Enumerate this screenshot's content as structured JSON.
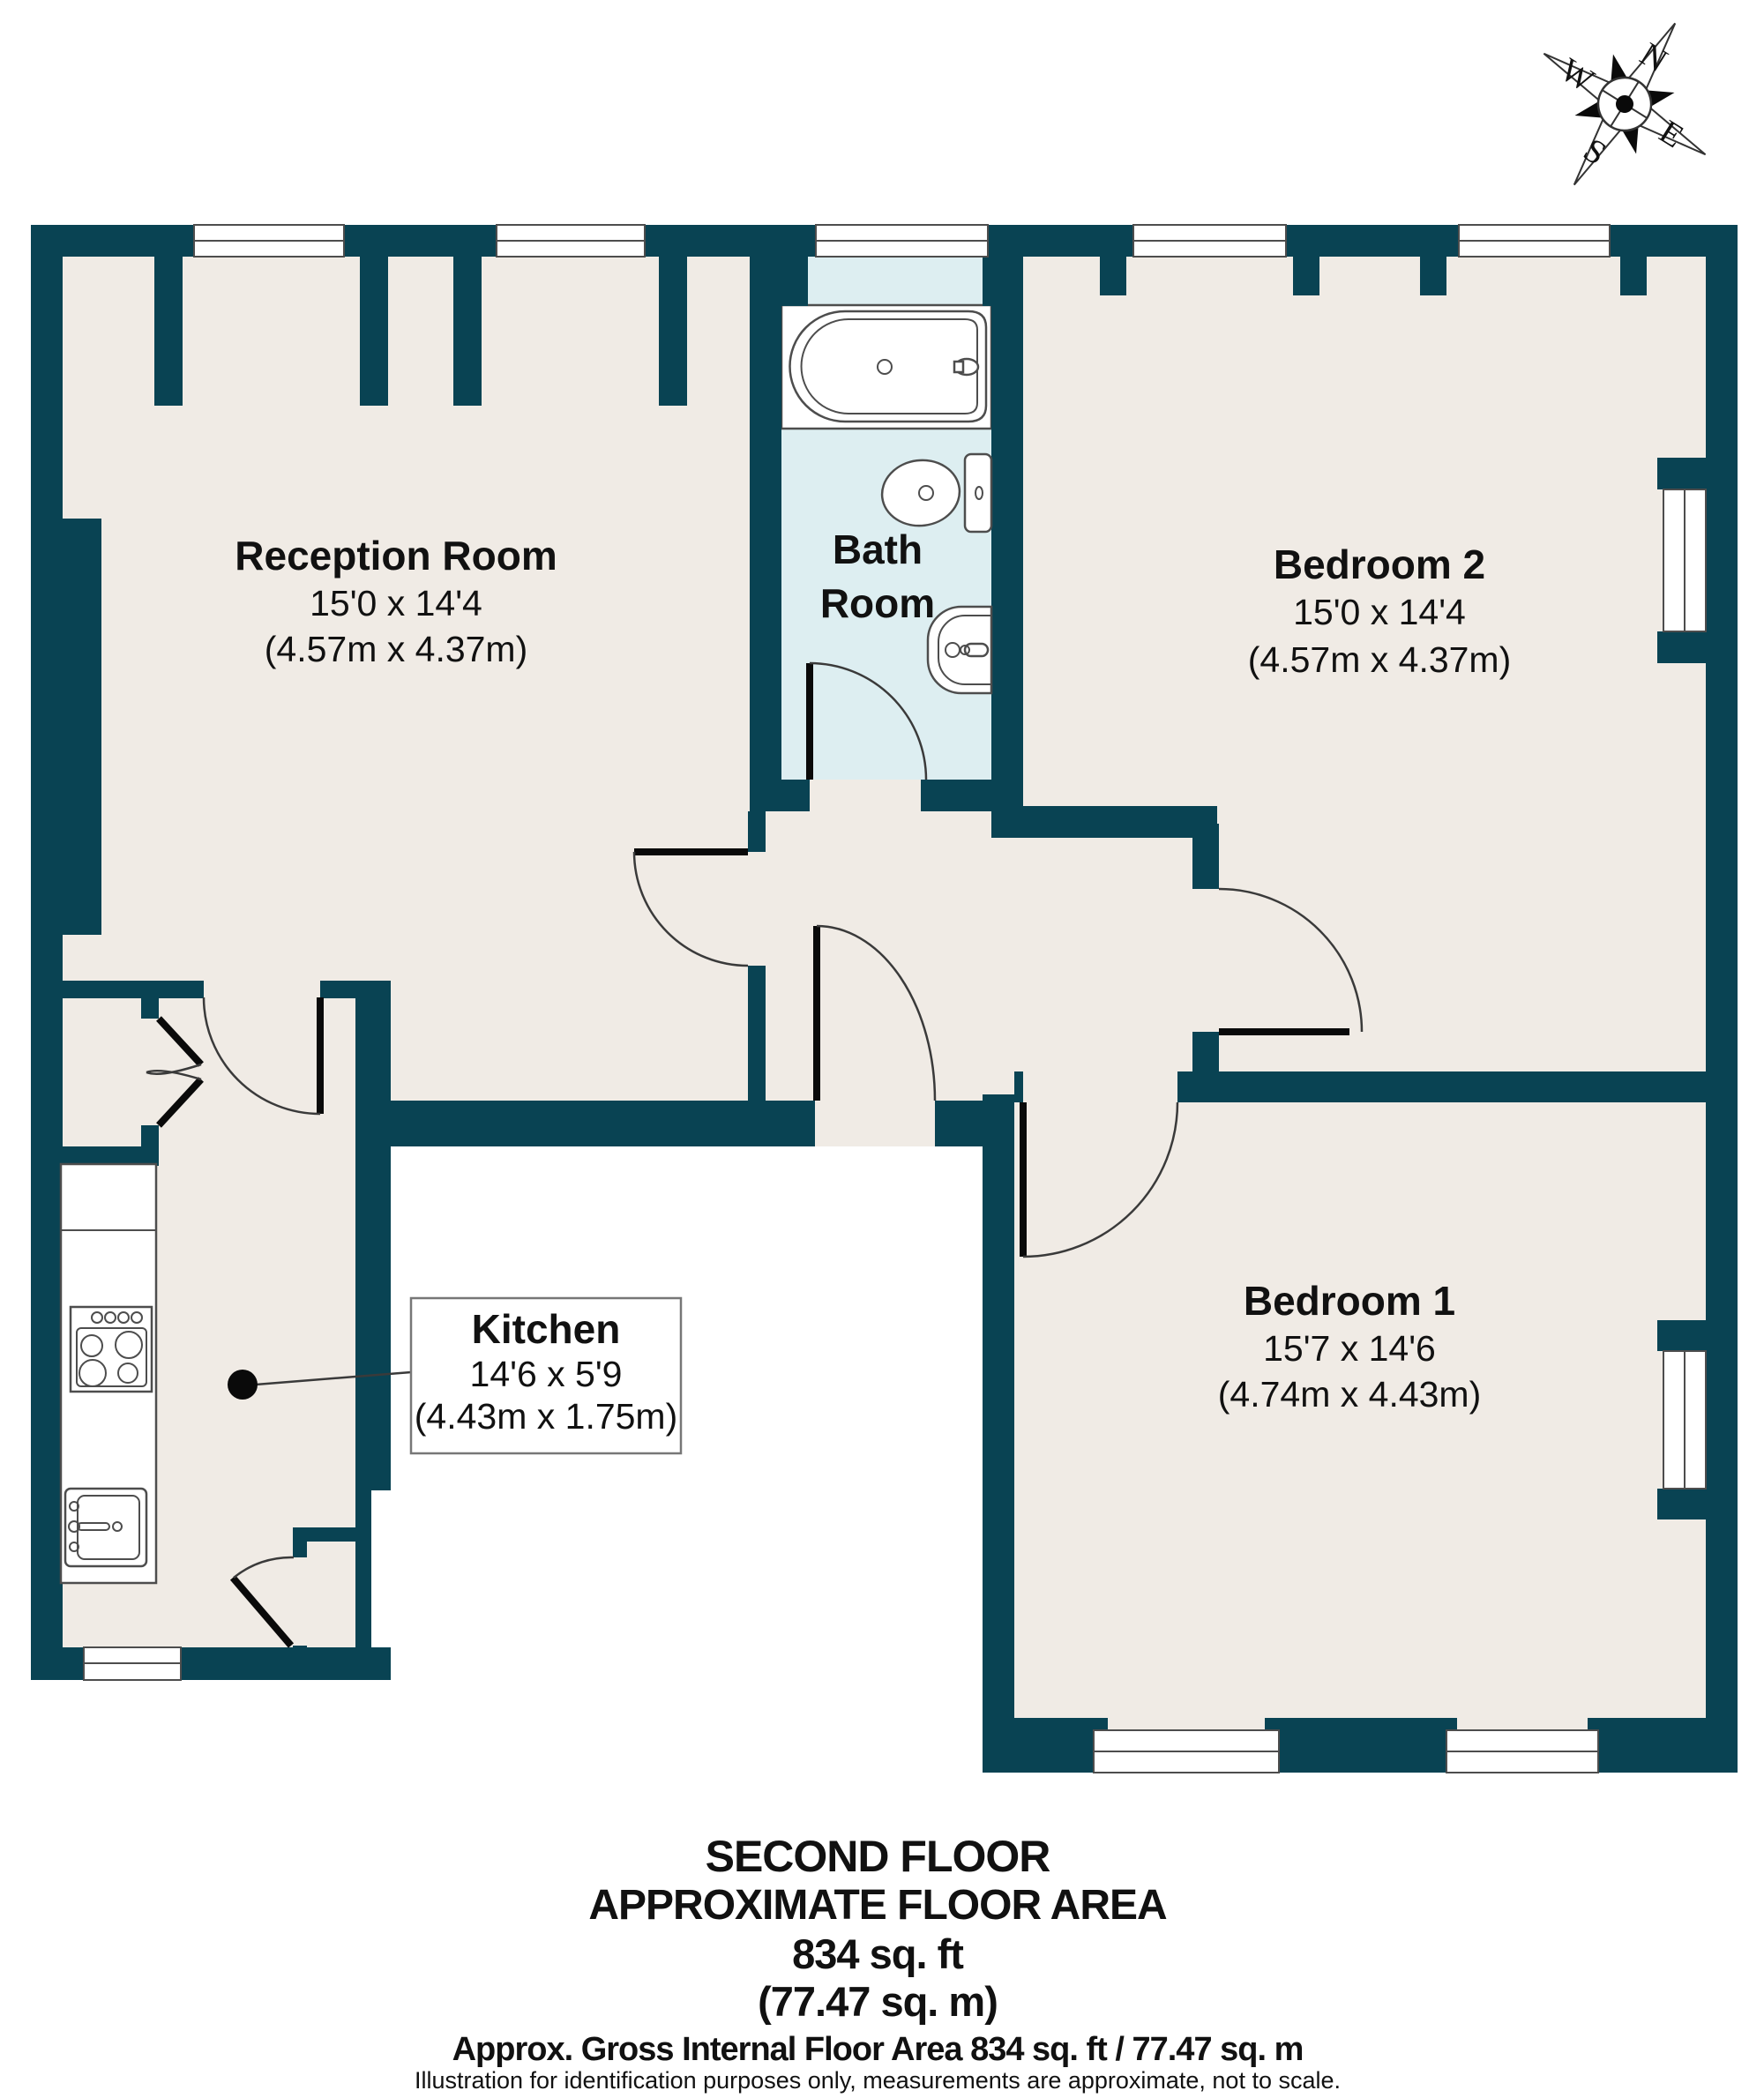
{
  "colors": {
    "wall": "#094353",
    "floor": "#f0ebe5",
    "bathfloor": "#ddeef1",
    "line": "#4d4d4d"
  },
  "rooms": {
    "reception": {
      "name": "Reception Room",
      "imperial": "15'0 x 14'4",
      "metric": "(4.57m x 4.37m)"
    },
    "bathroom": {
      "name_line1": "Bath",
      "name_line2": "Room"
    },
    "bedroom2": {
      "name": "Bedroom 2",
      "imperial": "15'0 x 14'4",
      "metric": "(4.57m x 4.37m)"
    },
    "bedroom1": {
      "name": "Bedroom 1",
      "imperial": "15'7 x 14'6",
      "metric": "(4.74m x 4.43m)"
    },
    "kitchen": {
      "name": "Kitchen",
      "imperial": "14'6 x 5'9",
      "metric": "(4.43m x 1.75m)"
    }
  },
  "compass": {
    "north": "N",
    "east": "E",
    "south": "S",
    "west": "W"
  },
  "footer": {
    "line1": "SECOND FLOOR",
    "line2": "APPROXIMATE FLOOR AREA",
    "line3": "834 sq. ft",
    "line4": "(77.47 sq. m)",
    "line5": "Approx. Gross Internal Floor Area 834 sq. ft / 77.47 sq. m",
    "line6": "Illustration for identification purposes only, measurements are approximate, not to scale."
  }
}
